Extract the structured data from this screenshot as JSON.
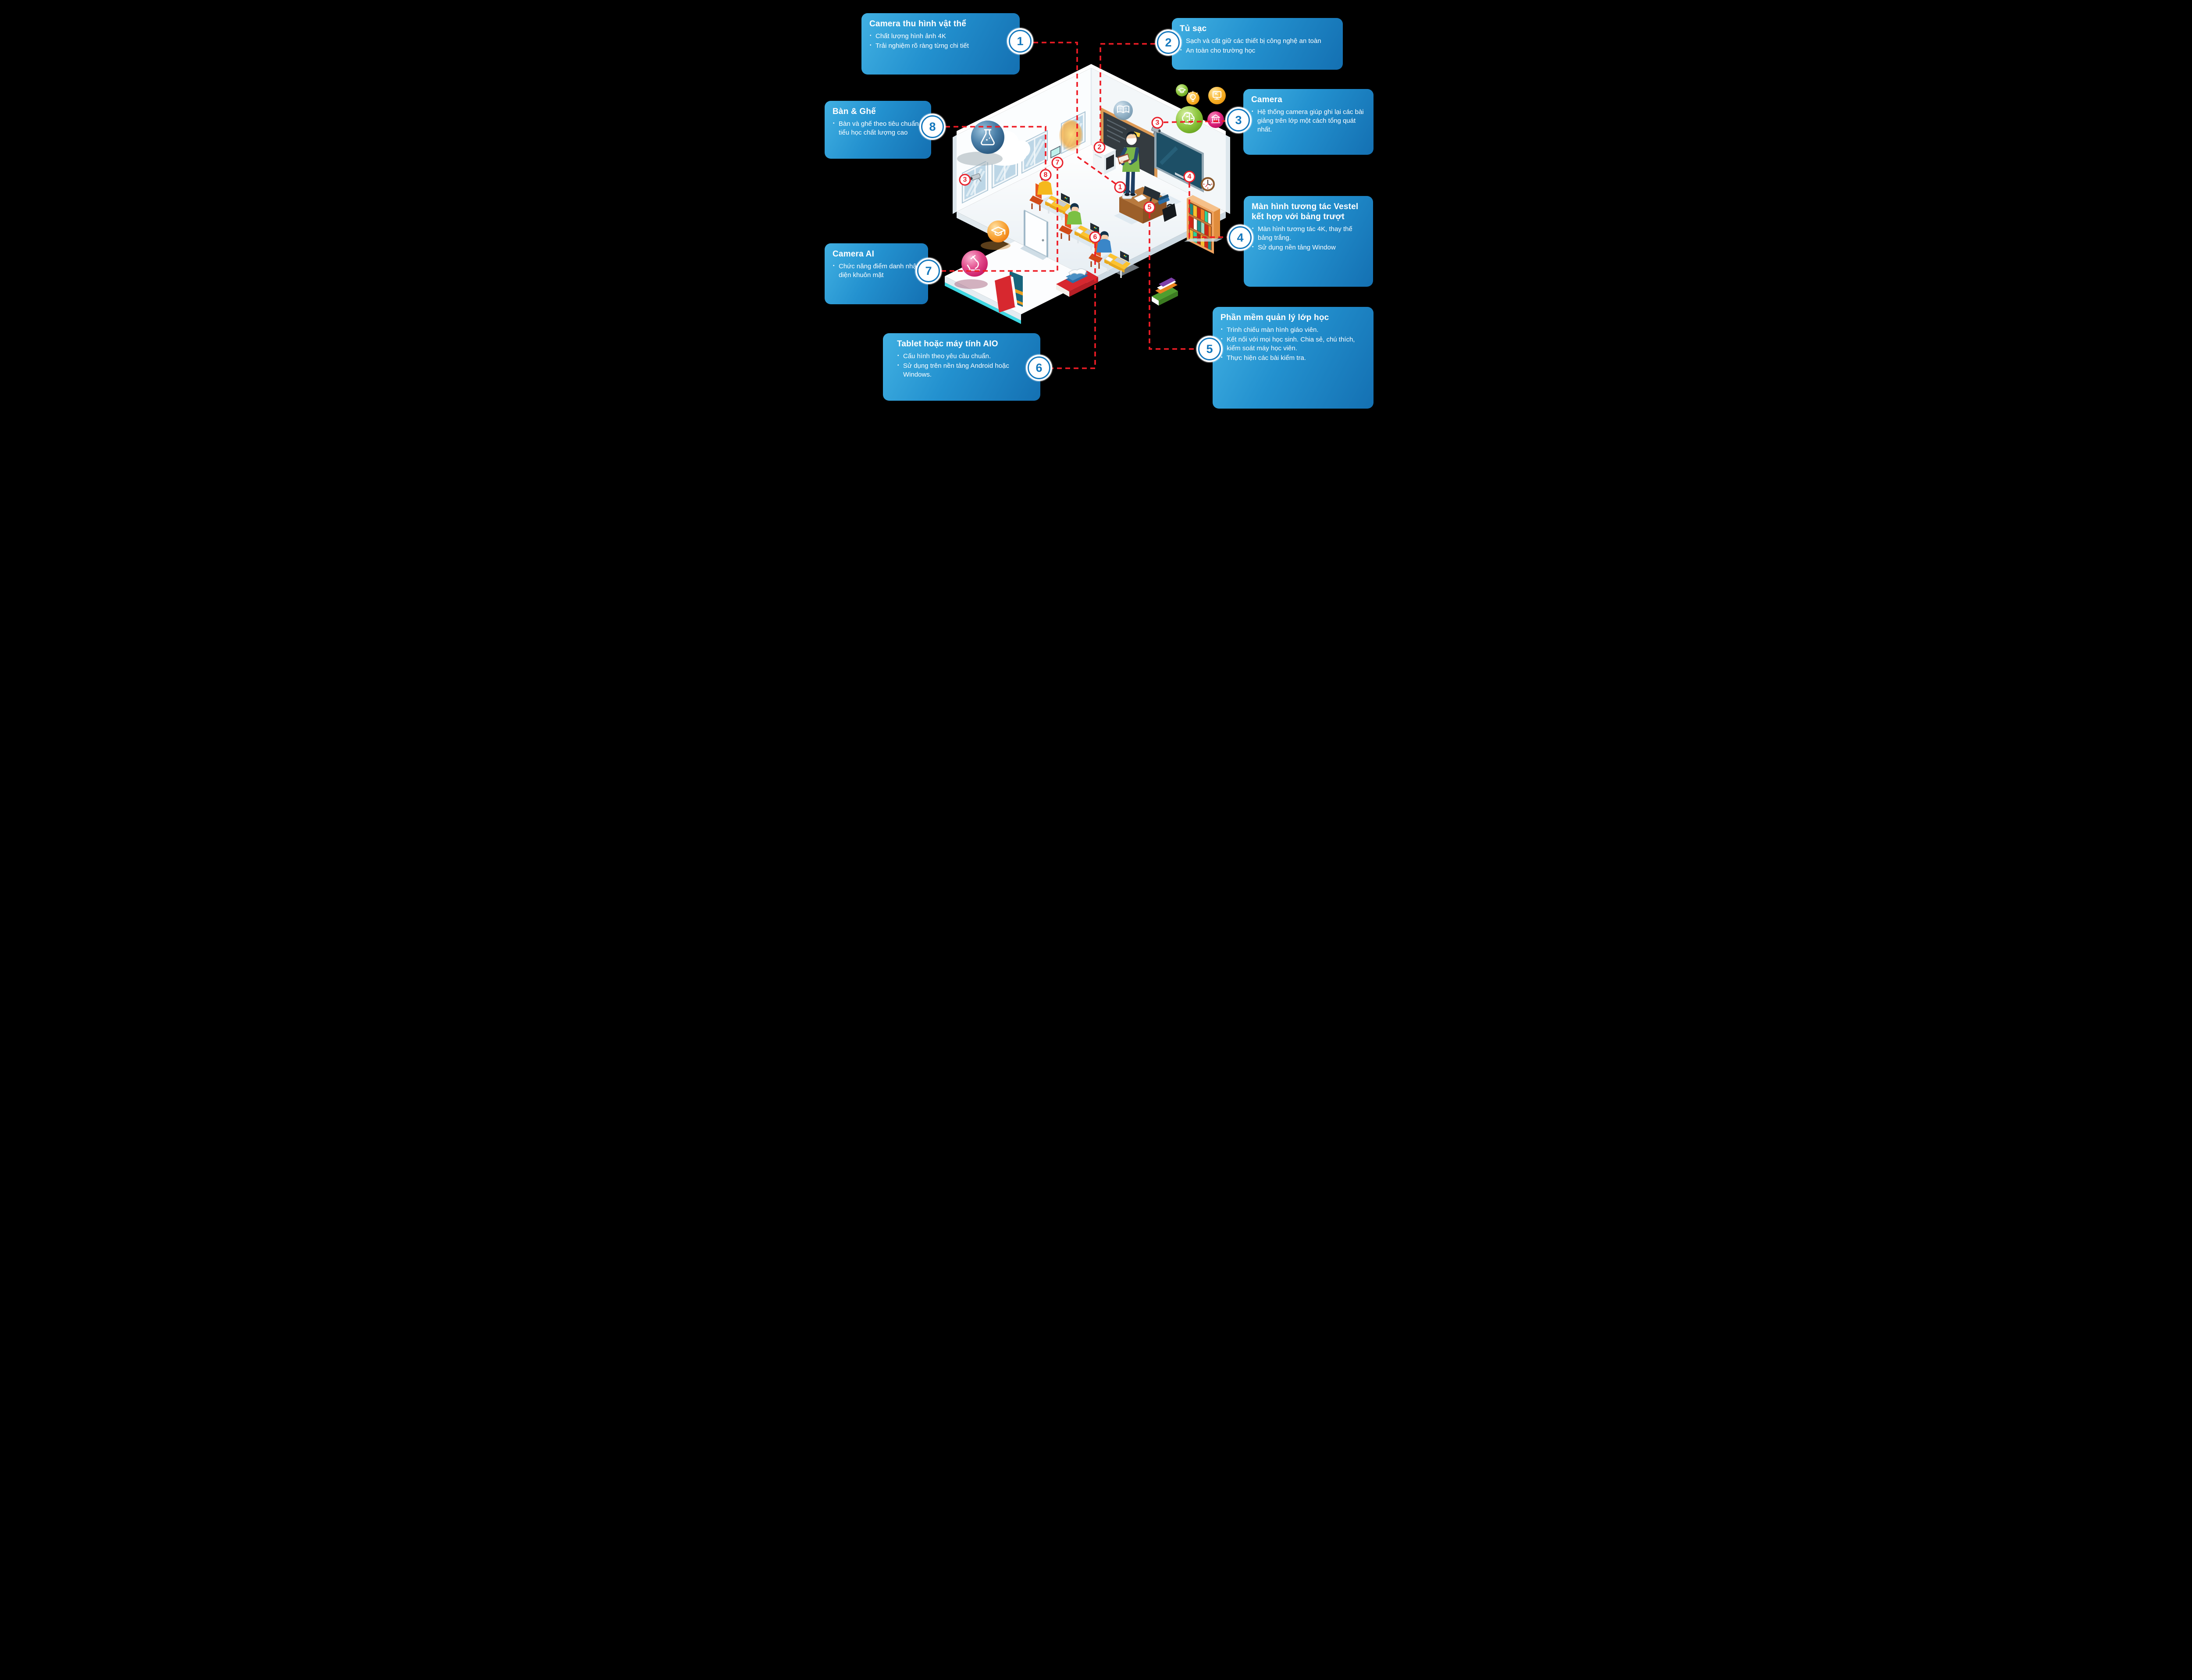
{
  "title": "Smart classroom infographic",
  "colors": {
    "background": "#000000",
    "panel_gradient_start": "#41b0e2",
    "panel_gradient_end": "#1470b2",
    "circle_blue": "#1478bd",
    "badge_red": "#e8212b",
    "dashed_line_red": "#ee1c25",
    "desk_yellow": "#fdc32e",
    "chair_orange": "#e0512a",
    "board_dark": "#343b40",
    "screen_teal": "#1d4f66",
    "shelf_orange": "#f0a45f"
  },
  "callouts": [
    {
      "number": "1",
      "title": "Camera thu hình vật thể",
      "bullets": [
        "Chất lượng hình ảnh 4K",
        "Trải nghiệm rõ ràng từng chi tiết"
      ]
    },
    {
      "number": "2",
      "title": "Tủ sạc",
      "bullets": [
        "Sạch và cất giữ các thiết bị công nghệ an toàn",
        "An toàn cho trường học"
      ]
    },
    {
      "number": "3",
      "title": "Camera",
      "bullets": [
        "Hệ thống camera giúp ghi lại các bài giảng trên lớp một cách tổng quát nhất."
      ]
    },
    {
      "number": "4",
      "title": "Màn hình tương tác Vestel kết hợp với bảng trượt",
      "bullets": [
        "Màn hình tương tác 4K, thay thế bảng trắng.",
        "Sử dụng nền tảng Window"
      ]
    },
    {
      "number": "5",
      "title": "Phần mềm quản lý lớp học",
      "bullets": [
        "Trình chiếu màn hình giáo viên.",
        "Kết nối với mọi học sinh. Chia sẻ, chú thích, kiểm soát máy học viên.",
        "Thực hiện các bài kiểm tra."
      ]
    },
    {
      "number": "6",
      "title": "Tablet hoặc máy tính AIO",
      "bullets": [
        "Cấu hình theo yêu cầu chuẩn.",
        "Sử dụng trên nền tảng Android hoặc Windows."
      ]
    },
    {
      "number": "7",
      "title": "Camera AI",
      "bullets": [
        "Chức năng điểm danh nhận diện khuôn mặt"
      ]
    },
    {
      "number": "8",
      "title": "Bàn & Ghế",
      "bullets": [
        "Bàn và ghế theo tiêu chuẩn tiểu học chất lượng cao"
      ]
    }
  ],
  "badges": [
    {
      "label": "1",
      "name": "document-camera"
    },
    {
      "label": "2",
      "name": "charging-cabinet"
    },
    {
      "label": "3",
      "name": "wall-camera"
    },
    {
      "label": "3",
      "name": "recording-camera"
    },
    {
      "label": "4",
      "name": "interactive-screen"
    },
    {
      "label": "5",
      "name": "classroom-software"
    },
    {
      "label": "6",
      "name": "student-tablet"
    },
    {
      "label": "7",
      "name": "ai-camera"
    },
    {
      "label": "8",
      "name": "desk-and-chair"
    }
  ],
  "icons": {
    "flask": "⚗",
    "graduation-cap": "🎓",
    "microscope": "🔬",
    "brain": "🧠",
    "bank": "🏛",
    "monitor": "🖥",
    "lightbulb": "💡",
    "open-book": "📖",
    "camera": "📷",
    "clock": "🕙"
  }
}
